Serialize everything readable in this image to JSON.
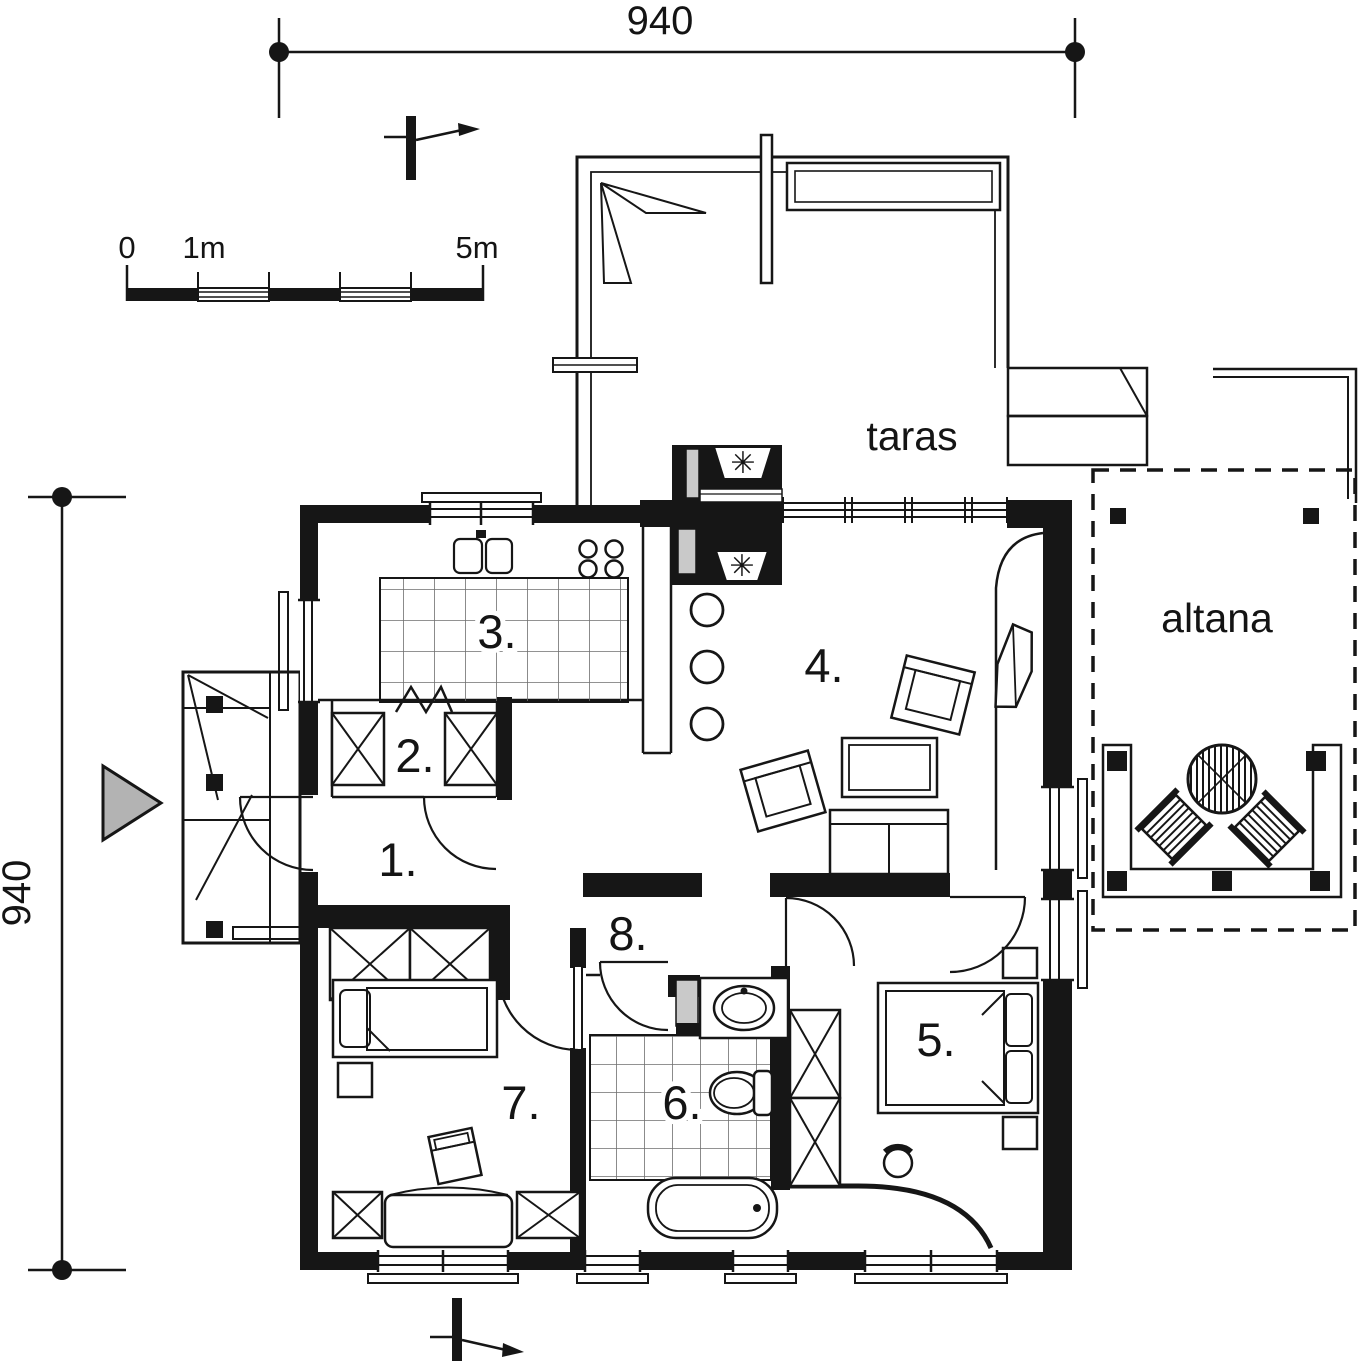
{
  "dimensions": {
    "top": "940",
    "left": "940"
  },
  "scale_bar": {
    "zero": "0",
    "one_m": "1m",
    "five_m": "5m"
  },
  "areas": {
    "terrace": "taras",
    "gazebo": "altana"
  },
  "rooms": [
    {
      "number": "1."
    },
    {
      "number": "2."
    },
    {
      "number": "3."
    },
    {
      "number": "4."
    },
    {
      "number": "5."
    },
    {
      "number": "6."
    },
    {
      "number": "7."
    },
    {
      "number": "8."
    }
  ],
  "symbols": {
    "flue": "✳"
  },
  "colors": {
    "line": "#161616",
    "entrance_arrow": "#b3b3b3",
    "shading": "#c9c9c9",
    "background": "#ffffff"
  }
}
